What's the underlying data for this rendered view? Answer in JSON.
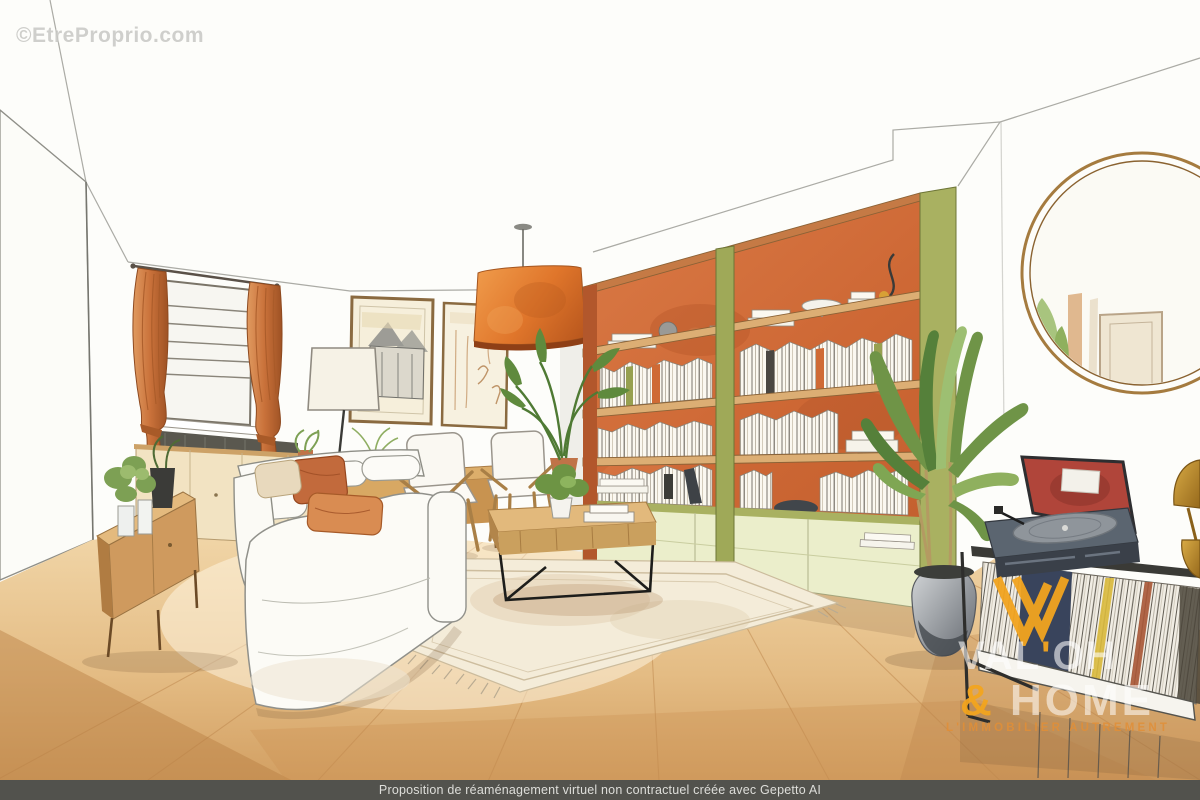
{
  "watermark": {
    "text": "©EtreProprio.com"
  },
  "brand": {
    "monogram": "W",
    "name_line1_pre": "VAL",
    "name_line1_apostrophe": "'",
    "name_line1_post": "OH",
    "name_line2_amp": "&",
    "name_line2_word": "HOME",
    "tagline": "L'IMMOBILIER AUTREMENT",
    "monogram_color": "#f2a41f"
  },
  "footer": {
    "disclaimer": "Proposition de réaménagement virtuel non contractuel créée avec Gepetto AI"
  },
  "scene": {
    "type": "watercolor interior rendering of a living room (virtual staging)",
    "objects": [
      "orange curtains on left window",
      "radiator under window",
      "cream sideboard",
      "wood media console with plants",
      "white fabric sofa with rust pillows",
      "floor lamp",
      "two framed sketches",
      "two wood armchairs with white cushions",
      "wood coffee table with black metal base",
      "cream rug with fringe",
      "orange pendant drum lamp",
      "large orange bookshelf wall with olive green sides",
      "rows of books and decor objects",
      "small palm plant",
      "tall green plant in grey pot",
      "round brass mirror on right wall",
      "vintage turntable with red lid",
      "black record console filled with vinyl records",
      "brass table lamp"
    ],
    "palette": {
      "wall": "#fbfaf5",
      "floor_light": "#f2d8ab",
      "floor_dark": "#c78d4f",
      "curtain_orange": "#c9713a",
      "pendant_shade": "#df7b2e",
      "bookshelf_back": "#d06c39",
      "bookshelf_green": "#a3ad5c",
      "base_cabinet": "#ebeecb",
      "sofa_white": "#faf9f4",
      "rug_cream": "#f4ecd9",
      "record_lid_red": "#b0453a",
      "plant_green": "#6f9447",
      "mirror_frame": "#a57b3f",
      "brand_orange": "#f2a41f",
      "footer_bar": "#52524d"
    }
  }
}
